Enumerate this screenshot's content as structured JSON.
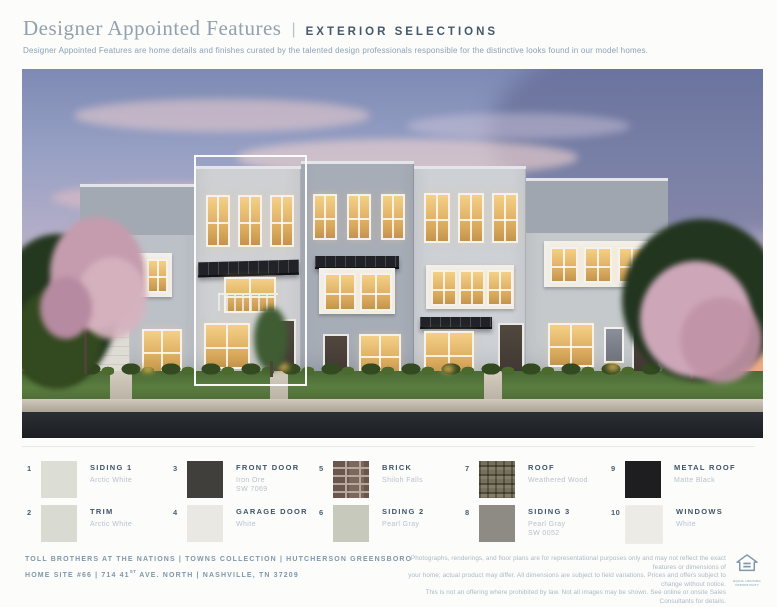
{
  "header": {
    "title": "Designer Appointed Features",
    "separator": "|",
    "section": "EXTERIOR SELECTIONS",
    "description": "Designer Appointed Features are home details and finishes curated by the talented design professionals responsible for the distinctive looks found in our model homes."
  },
  "selections": [
    {
      "num": "1",
      "name": "SIDING 1",
      "detail1": "Arctic White",
      "detail2": "",
      "color": "#dcddd5"
    },
    {
      "num": "2",
      "name": "TRIM",
      "detail1": "Arctic White",
      "detail2": "",
      "color": "#d9dad2"
    },
    {
      "num": "3",
      "name": "FRONT DOOR",
      "detail1": "Iron Ore",
      "detail2": "SW 7069",
      "color": "#403f3c"
    },
    {
      "num": "4",
      "name": "GARAGE DOOR",
      "detail1": "White",
      "detail2": "",
      "color": "#e9e8e3"
    },
    {
      "num": "5",
      "name": "BRICK",
      "detail1": "Shiloh Falls",
      "detail2": "",
      "color": "#6f5b51"
    },
    {
      "num": "6",
      "name": "SIDING 2",
      "detail1": "Pearl Gray",
      "detail2": "",
      "color": "#c6c9bc"
    },
    {
      "num": "7",
      "name": "ROOF",
      "detail1": "Weathered Wood",
      "detail2": "",
      "color": "#6c6754"
    },
    {
      "num": "8",
      "name": "SIDING 3",
      "detail1": "Pearl Gray",
      "detail2": "SW 0052",
      "color": "#8e8b85"
    },
    {
      "num": "9",
      "name": "METAL ROOF",
      "detail1": "Matte Black",
      "detail2": "",
      "color": "#1e1e20"
    },
    {
      "num": "10",
      "name": "WINDOWS",
      "detail1": "White",
      "detail2": "",
      "color": "#edebe6"
    }
  ],
  "footer": {
    "community_line": "TOLL BROTHERS AT THE NATIONS   |   TOWNS COLLECTION   |   HUTCHERSON GREENSBORO",
    "address_pre": "HOME SITE #66   |   714 41",
    "address_sup": "ST",
    "address_post": " AVE. NORTH   |   NASHVILLE, TN 37209",
    "disclaimer": [
      "Photographs, renderings, and floor plans are for representational purposes only and may not reflect the exact features or dimensions of",
      "your home; actual product may differ. All dimensions are subject to field variations. Prices and offers subject to change without notice.",
      "This is not an offering where prohibited by law. Not all images may be shown. See online or onsite Sales Consultants for details."
    ],
    "equal_housing_label": "EQUAL HOUSING OPPORTUNITY"
  }
}
